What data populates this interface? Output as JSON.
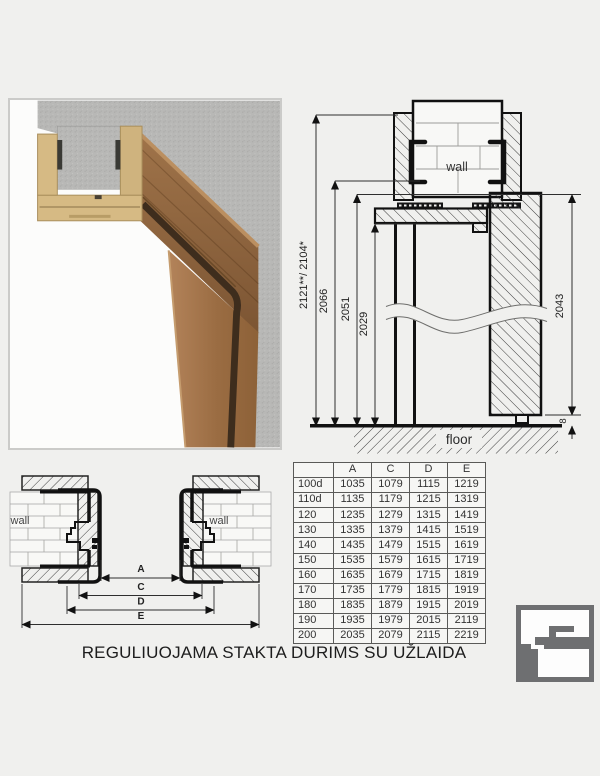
{
  "page": {
    "title": "REGULIUOJAMA STAKTA DURIMS SU UŽLAIDA"
  },
  "vertical_section": {
    "wall_label": "wall",
    "floor_label": "floor",
    "dim_total": "2121**/ 2104*",
    "dim_frame_outer": "2066",
    "dim_frame_rebate": "2051",
    "dim_clear_opening": "2029",
    "dim_door_leaf": "2043",
    "dim_floor_gap": "8"
  },
  "plan_section": {
    "wall_left_label": "wall",
    "wall_right_label": "wall",
    "dim_a": "A",
    "dim_c": "C",
    "dim_d": "D",
    "dim_e": "E"
  },
  "table": {
    "headers": [
      "",
      "A",
      "C",
      "D",
      "E"
    ],
    "rows": [
      [
        "100d",
        "1035",
        "1079",
        "1115",
        "1219"
      ],
      [
        "110d",
        "1135",
        "1179",
        "1215",
        "1319"
      ],
      [
        "120",
        "1235",
        "1279",
        "1315",
        "1419"
      ],
      [
        "130",
        "1335",
        "1379",
        "1415",
        "1519"
      ],
      [
        "140",
        "1435",
        "1479",
        "1515",
        "1619"
      ],
      [
        "150",
        "1535",
        "1579",
        "1615",
        "1719"
      ],
      [
        "160",
        "1635",
        "1679",
        "1715",
        "1819"
      ],
      [
        "170",
        "1735",
        "1779",
        "1815",
        "1919"
      ],
      [
        "180",
        "1835",
        "1879",
        "1915",
        "2019"
      ],
      [
        "190",
        "1935",
        "1979",
        "2015",
        "2119"
      ],
      [
        "200",
        "2035",
        "2079",
        "2115",
        "2219"
      ]
    ]
  },
  "logo": {
    "icon": "door-frame-profile-logo"
  },
  "colors": {
    "line": "#161616",
    "dim_line": "#2e2e2e",
    "logo_gray": "#6e6f71",
    "concrete": "#b8b8b6",
    "mdf_cream": "#d6ba84",
    "wood_front": "#8a603a",
    "wood_light": "#b3835a",
    "gasket": "#3e2d1d"
  }
}
